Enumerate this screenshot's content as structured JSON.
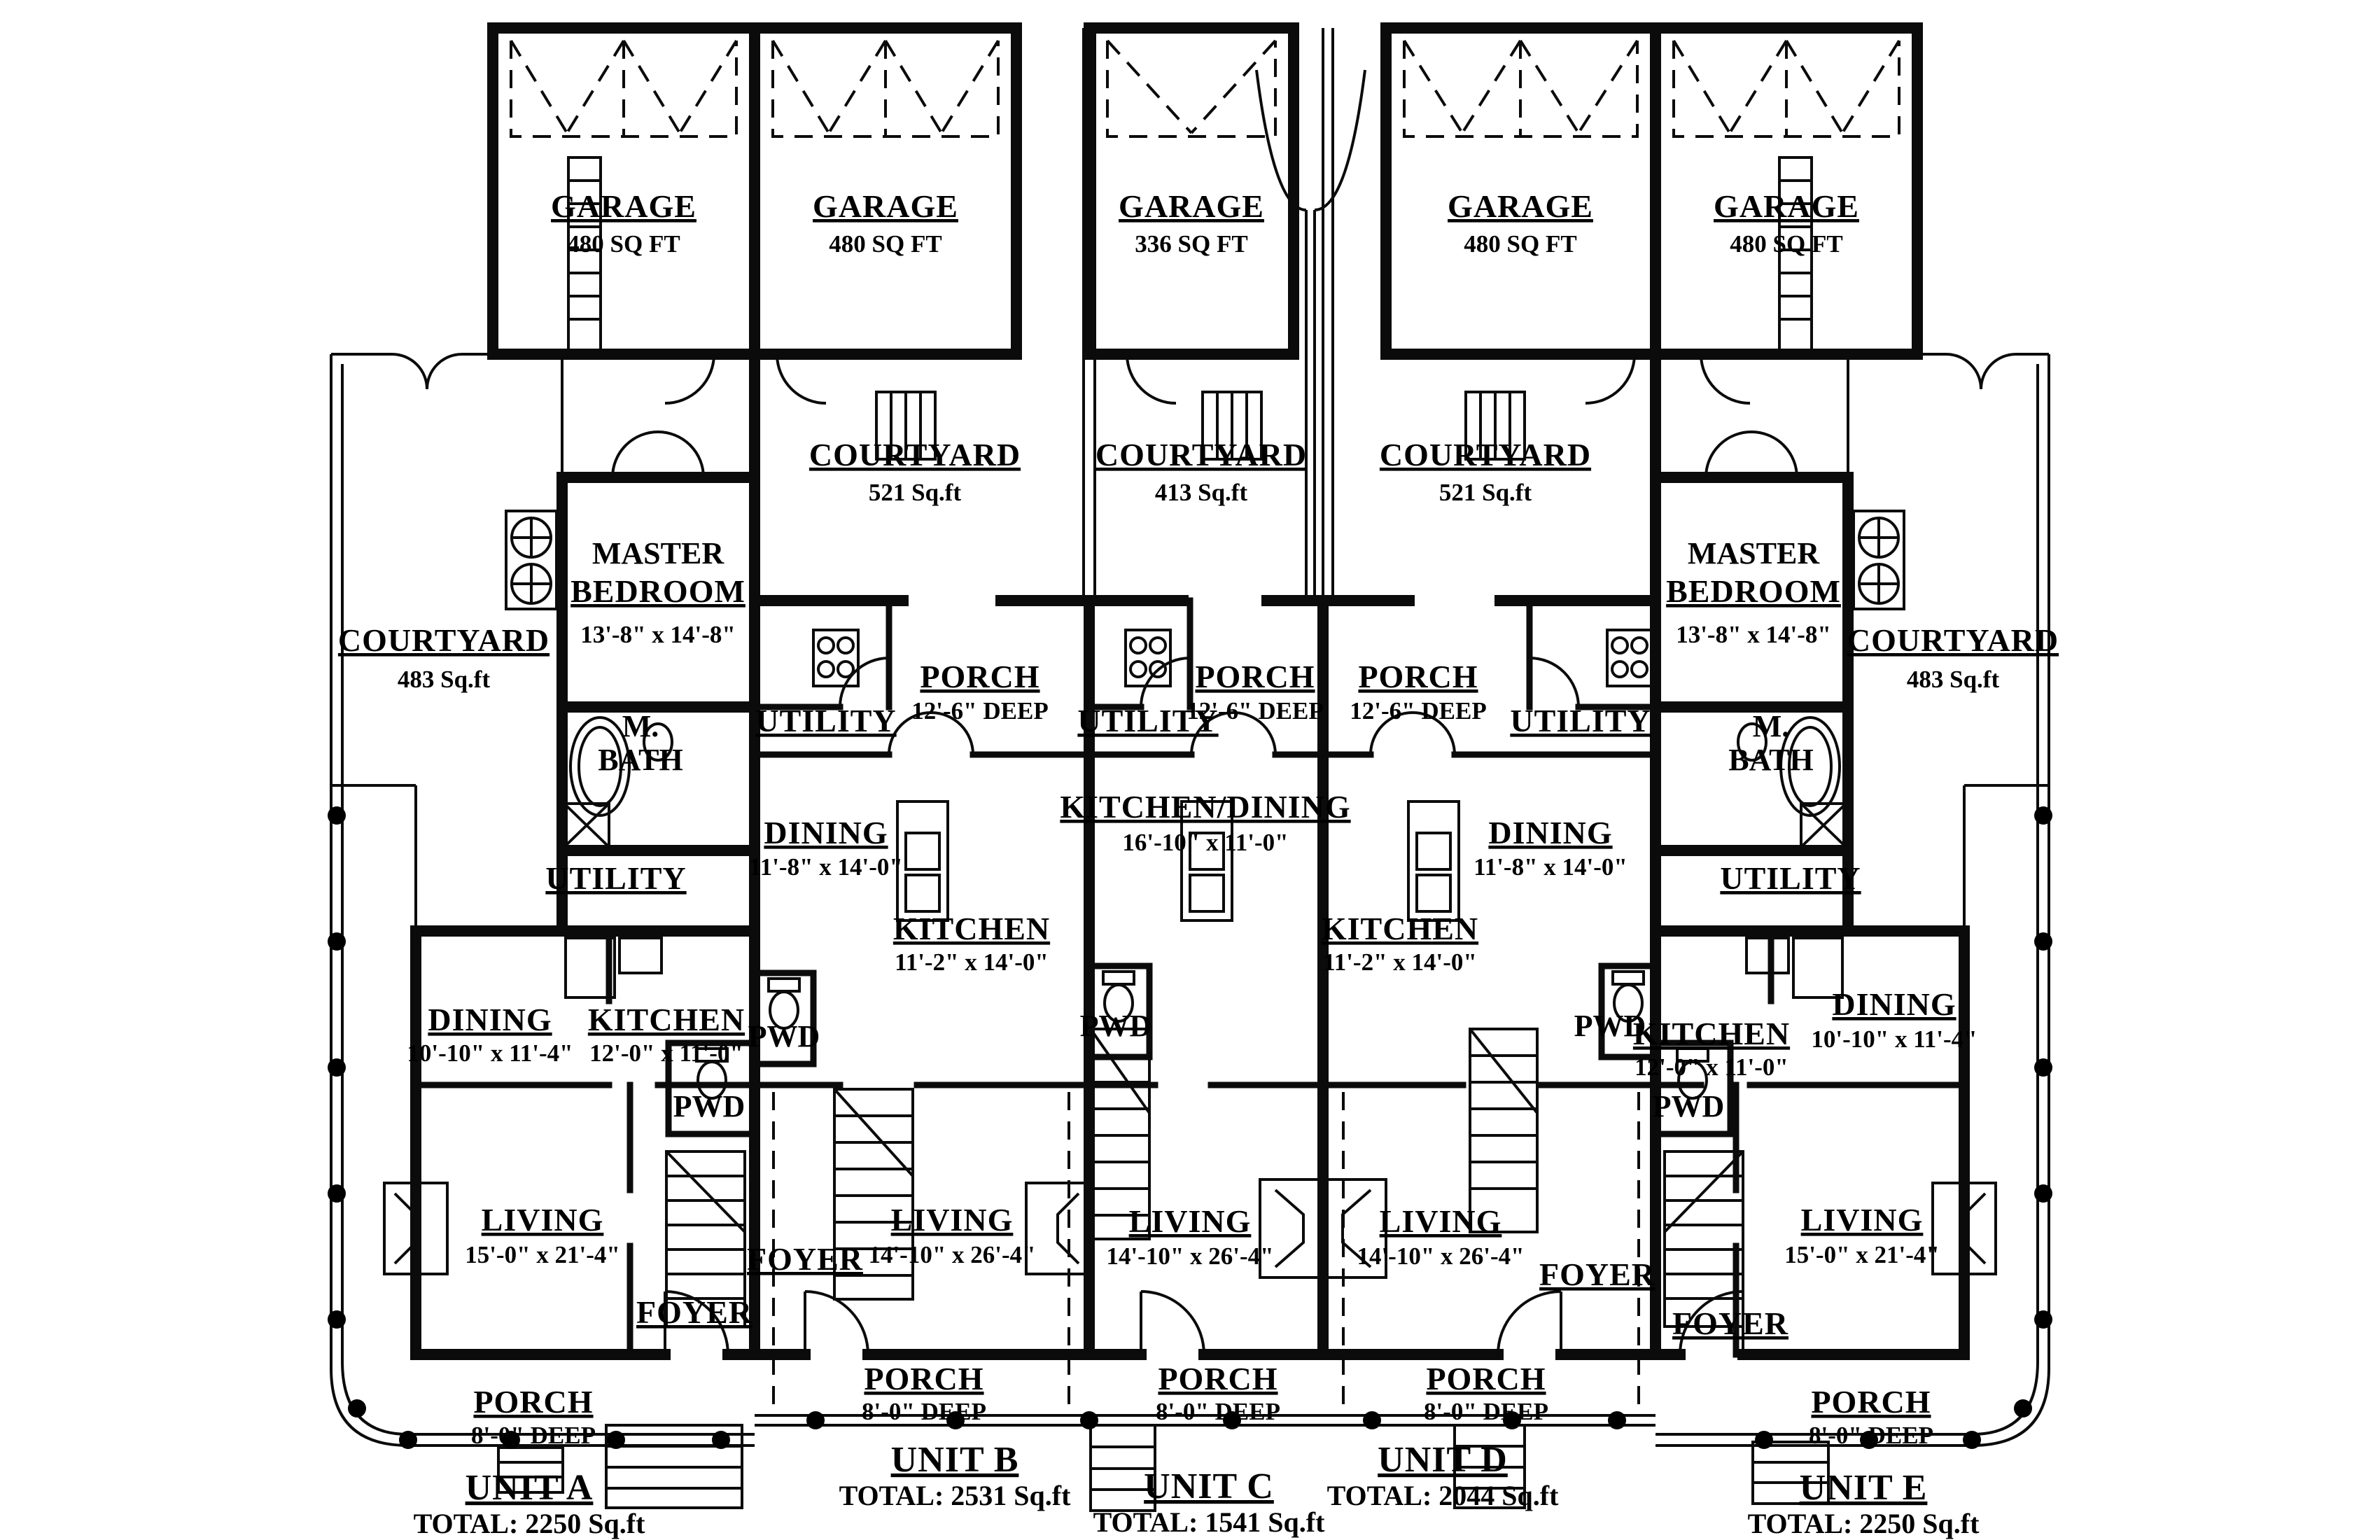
{
  "labels": {
    "garage_a": {
      "name": "GARAGE",
      "detail": "480 SQ FT"
    },
    "garage_b": {
      "name": "GARAGE",
      "detail": "480 SQ FT"
    },
    "garage_c": {
      "name": "GARAGE",
      "detail": "336 SQ FT"
    },
    "garage_d": {
      "name": "GARAGE",
      "detail": "480 SQ FT"
    },
    "garage_e": {
      "name": "GARAGE",
      "detail": "480 SQ FT"
    },
    "courtyard_a": {
      "name": "COURTYARD",
      "detail": "483 Sq.ft"
    },
    "courtyard_b": {
      "name": "COURTYARD",
      "detail": "521 Sq.ft"
    },
    "courtyard_c": {
      "name": "COURTYARD",
      "detail": "413 Sq.ft"
    },
    "courtyard_d": {
      "name": "COURTYARD",
      "detail": "521 Sq.ft"
    },
    "courtyard_e": {
      "name": "COURTYARD",
      "detail": "483 Sq.ft"
    },
    "master_bedroom_a": {
      "line1": "MASTER",
      "line2": "BEDROOM",
      "detail": "13'-8\" x 14'-8\""
    },
    "master_bedroom_e": {
      "line1": "MASTER",
      "line2": "BEDROOM",
      "detail": "13'-8\" x 14'-8\""
    },
    "master_bath_a": {
      "line1": "M.",
      "line2": "BATH"
    },
    "master_bath_e": {
      "line1": "M.",
      "line2": "BATH"
    },
    "utility_a": {
      "name": "UTILITY"
    },
    "utility_b": {
      "name": "UTILITY"
    },
    "utility_c": {
      "name": "UTILITY"
    },
    "utility_d": {
      "name": "UTILITY"
    },
    "utility_e": {
      "name": "UTILITY"
    },
    "porch_mid_b": {
      "name": "PORCH",
      "detail": "12'-6\" DEEP"
    },
    "porch_mid_c": {
      "name": "PORCH",
      "detail": "12'-6\" DEEP"
    },
    "porch_mid_d": {
      "name": "PORCH",
      "detail": "12'-6\" DEEP"
    },
    "dining_a": {
      "name": "DINING",
      "detail": "10'-10\" x 11'-4\""
    },
    "dining_b": {
      "name": "DINING",
      "detail": "11'-8\" x 14'-0\""
    },
    "dining_d": {
      "name": "DINING",
      "detail": "11'-8\" x 14'-0\""
    },
    "dining_e": {
      "name": "DINING",
      "detail": "10'-10\" x 11'-4\""
    },
    "kitchen_a": {
      "name": "KITCHEN",
      "detail": "12'-0\" x 11'-0\""
    },
    "kitchen_b": {
      "name": "KITCHEN",
      "detail": "11'-2\" x 14'-0\""
    },
    "kitchen_d": {
      "name": "KITCHEN",
      "detail": "11'-2\" x 14'-0\""
    },
    "kitchen_e": {
      "name": "KITCHEN",
      "detail": "12'-0\" x 11'-0\""
    },
    "kitchen_dining_c": {
      "name": "KITCHEN/DINING",
      "detail": "16'-10\" x 11'-0\""
    },
    "pwd_a": {
      "name": "PWD"
    },
    "pwd_b": {
      "name": "PWD"
    },
    "pwd_c": {
      "name": "PWD"
    },
    "pwd_d": {
      "name": "PWD"
    },
    "pwd_e": {
      "name": "PWD"
    },
    "living_a": {
      "name": "LIVING",
      "detail": "15'-0\" x 21'-4\""
    },
    "living_b": {
      "name": "LIVING",
      "detail": "14'-10\" x 26'-4\""
    },
    "living_c": {
      "name": "LIVING",
      "detail": "14'-10\" x 26'-4\""
    },
    "living_d": {
      "name": "LIVING",
      "detail": "14'-10\" x 26'-4\""
    },
    "living_e": {
      "name": "LIVING",
      "detail": "15'-0\" x 21'-4\""
    },
    "foyer_a": {
      "name": "FOYER"
    },
    "foyer_b": {
      "name": "FOYER"
    },
    "foyer_d": {
      "name": "FOYER"
    },
    "foyer_e": {
      "name": "FOYER"
    },
    "porch_front_a": {
      "name": "PORCH",
      "detail": "8'-0\" DEEP"
    },
    "porch_front_b": {
      "name": "PORCH",
      "detail": "8'-0\" DEEP"
    },
    "porch_front_c": {
      "name": "PORCH",
      "detail": "8'-0\" DEEP"
    },
    "porch_front_d": {
      "name": "PORCH",
      "detail": "8'-0\" DEEP"
    },
    "porch_front_e": {
      "name": "PORCH",
      "detail": "8'-0\" DEEP"
    },
    "unit_a": {
      "name": "UNIT A",
      "total": "TOTAL: 2250 Sq.ft"
    },
    "unit_b": {
      "name": "UNIT B",
      "total": "TOTAL: 2531 Sq.ft"
    },
    "unit_c": {
      "name": "UNIT C",
      "total": "TOTAL: 1541 Sq.ft"
    },
    "unit_d": {
      "name": "UNIT D",
      "total": "TOTAL: 2044 Sq.ft"
    },
    "unit_e": {
      "name": "UNIT E",
      "total": "TOTAL: 2250 Sq.ft"
    }
  }
}
